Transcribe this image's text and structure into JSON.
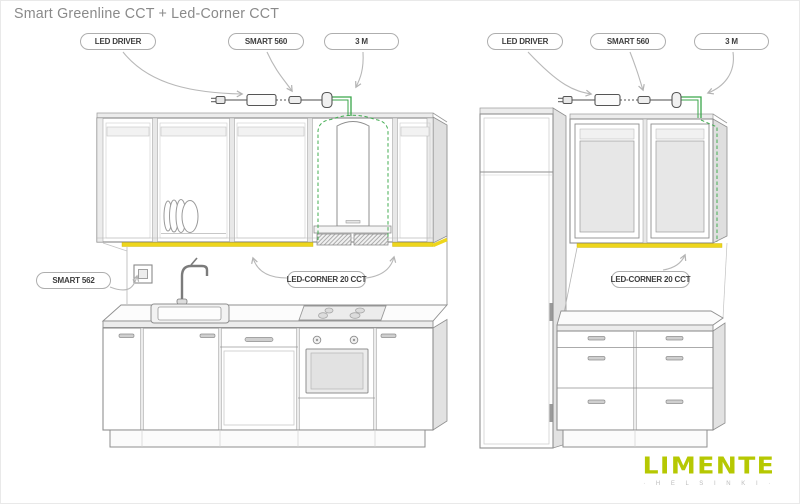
{
  "title": "Smart Greenline CCT + Led-Corner CCT",
  "labels": {
    "led_driver": "LED DRIVER",
    "smart_560": "SMART 560",
    "cable_3m": "3 M",
    "smart_562": "SMART 562",
    "led_corner": "LED-CORNER 20 CCT"
  },
  "logo": {
    "brand": "LIMENTE",
    "city": "· H E L S I N K I ·"
  },
  "colors": {
    "led_strip_yellow": "#eed61c",
    "cable_green": "#3aa64a",
    "dashed_green": "#43ad52",
    "logo_lime": "#b6c802"
  }
}
